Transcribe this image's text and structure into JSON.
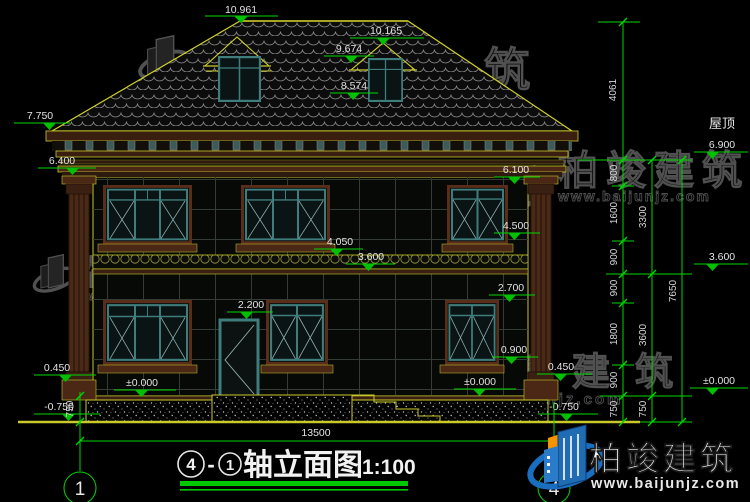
{
  "labels": {
    "roof_side": "屋顶"
  },
  "elevations": {
    "ridge": "10.961",
    "dormer_top": "10.165",
    "dormer_eave": "9.674",
    "dormer_sill": "8.574",
    "eave": "7.750",
    "cornice": "6.400",
    "roof_right": "6.900",
    "f2_win_top": "6.100",
    "f2_win_sill": "4.500",
    "band_top": "4.050",
    "f2_floor": "3.600",
    "f2_floor_right": "3.600",
    "f1_win_top": "2.700",
    "door_top": "2.200",
    "f1_win_sill": "0.900",
    "base_left": "0.450",
    "base_right": "0.450",
    "zero_left": "±0.000",
    "zero_mid": "±0.000",
    "zero_right": "±0.000",
    "ground_left": "-0.750",
    "ground_right": "-0.750"
  },
  "dims": {
    "roof_height": "4061",
    "total_width": "13500",
    "left_depth": "750",
    "chain_inner": [
      "800",
      "1600",
      "900",
      "900",
      "1800",
      "900",
      "750"
    ],
    "chain_mid": [
      "3300",
      "3600",
      "750"
    ],
    "chain_outer": [
      "7650"
    ]
  },
  "axes": {
    "left": "1",
    "right": "4"
  },
  "title": {
    "bubble_a": "4",
    "dash": "-",
    "bubble_b": "1",
    "text": "轴立面图",
    "scale": "1:100"
  },
  "brand": {
    "name": "柏竣建筑",
    "url": "www.baijunjz.com"
  }
}
